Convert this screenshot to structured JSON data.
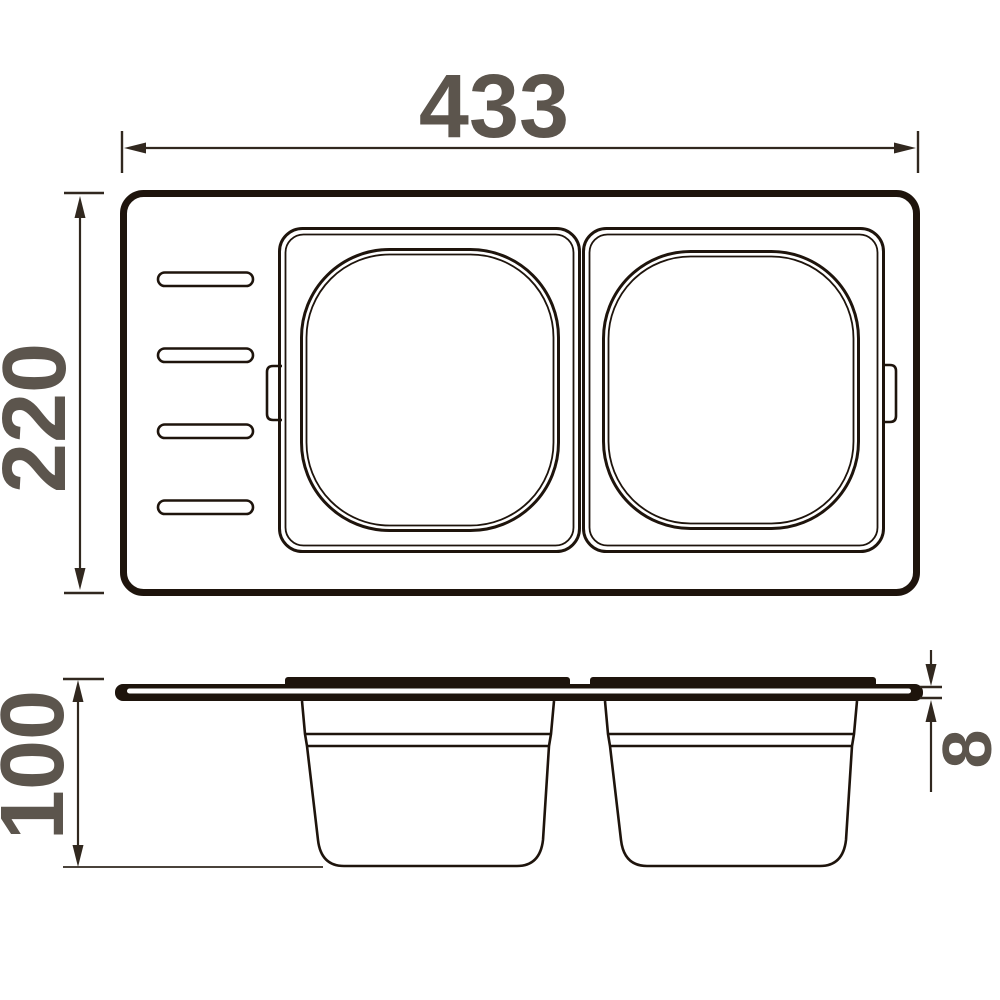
{
  "dimensions": {
    "width": "433",
    "height": "220",
    "depth": "100",
    "rim_thickness": "8"
  },
  "colors": {
    "ink": "#1e140c",
    "dim-line": "#31281f",
    "label": "#5c554d",
    "background": "#ffffff"
  }
}
